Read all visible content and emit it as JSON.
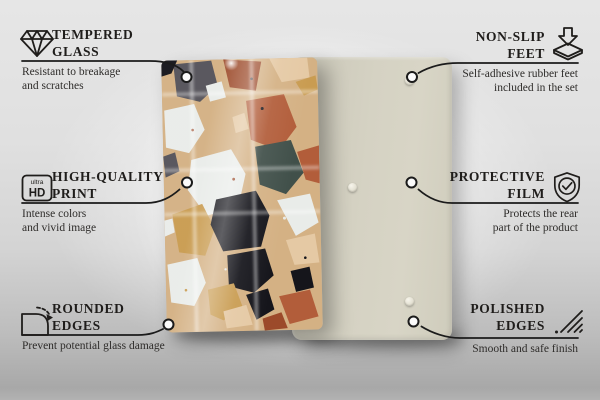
{
  "colors": {
    "line": "#1b1b1b",
    "circle-fill": "#fbfbfb",
    "text-title": "#1f1d1b",
    "text-desc": "#2e2c2a",
    "rear-panel": "#d5d2c3",
    "terrazzo-bg": "#d4b184",
    "terrazzo-white": "#e9ece9",
    "terrazzo-rust": "#b25d3a",
    "terrazzo-rust-dark": "#9c4a2a",
    "terrazzo-black": "#15151b",
    "terrazzo-gray": "#55535a",
    "terrazzo-teal": "#41504a",
    "terrazzo-gold": "#c99c51",
    "terrazzo-pale": "#e5c9a4"
  },
  "features": {
    "left": [
      {
        "icon": "diamond",
        "title": [
          "TEMPERED",
          "GLASS"
        ],
        "desc": [
          "Resistant to breakage",
          "and scratches"
        ]
      },
      {
        "icon": "ultra-hd",
        "title": [
          "HIGH-QUALITY",
          "PRINT"
        ],
        "desc": [
          "Intense colors",
          "and vivid image"
        ]
      },
      {
        "icon": "rounded-corner",
        "title": [
          "ROUNDED",
          "EDGES"
        ],
        "desc": [
          "Prevent potential glass damage"
        ]
      }
    ],
    "right": [
      {
        "icon": "non-slip-feet",
        "title": [
          "NON-SLIP",
          "FEET"
        ],
        "desc": [
          "Self-adhesive rubber feet",
          "included in the set"
        ]
      },
      {
        "icon": "shield-check",
        "title": [
          "PROTECTIVE",
          "FILM"
        ],
        "desc": [
          "Protects the rear",
          "part of the product"
        ]
      },
      {
        "icon": "polished-edges",
        "title": [
          "POLISHED",
          "EDGES"
        ],
        "desc": [
          "Smooth and safe finish"
        ]
      }
    ]
  },
  "hd_icon": {
    "small": "ultra",
    "large": "HD"
  }
}
